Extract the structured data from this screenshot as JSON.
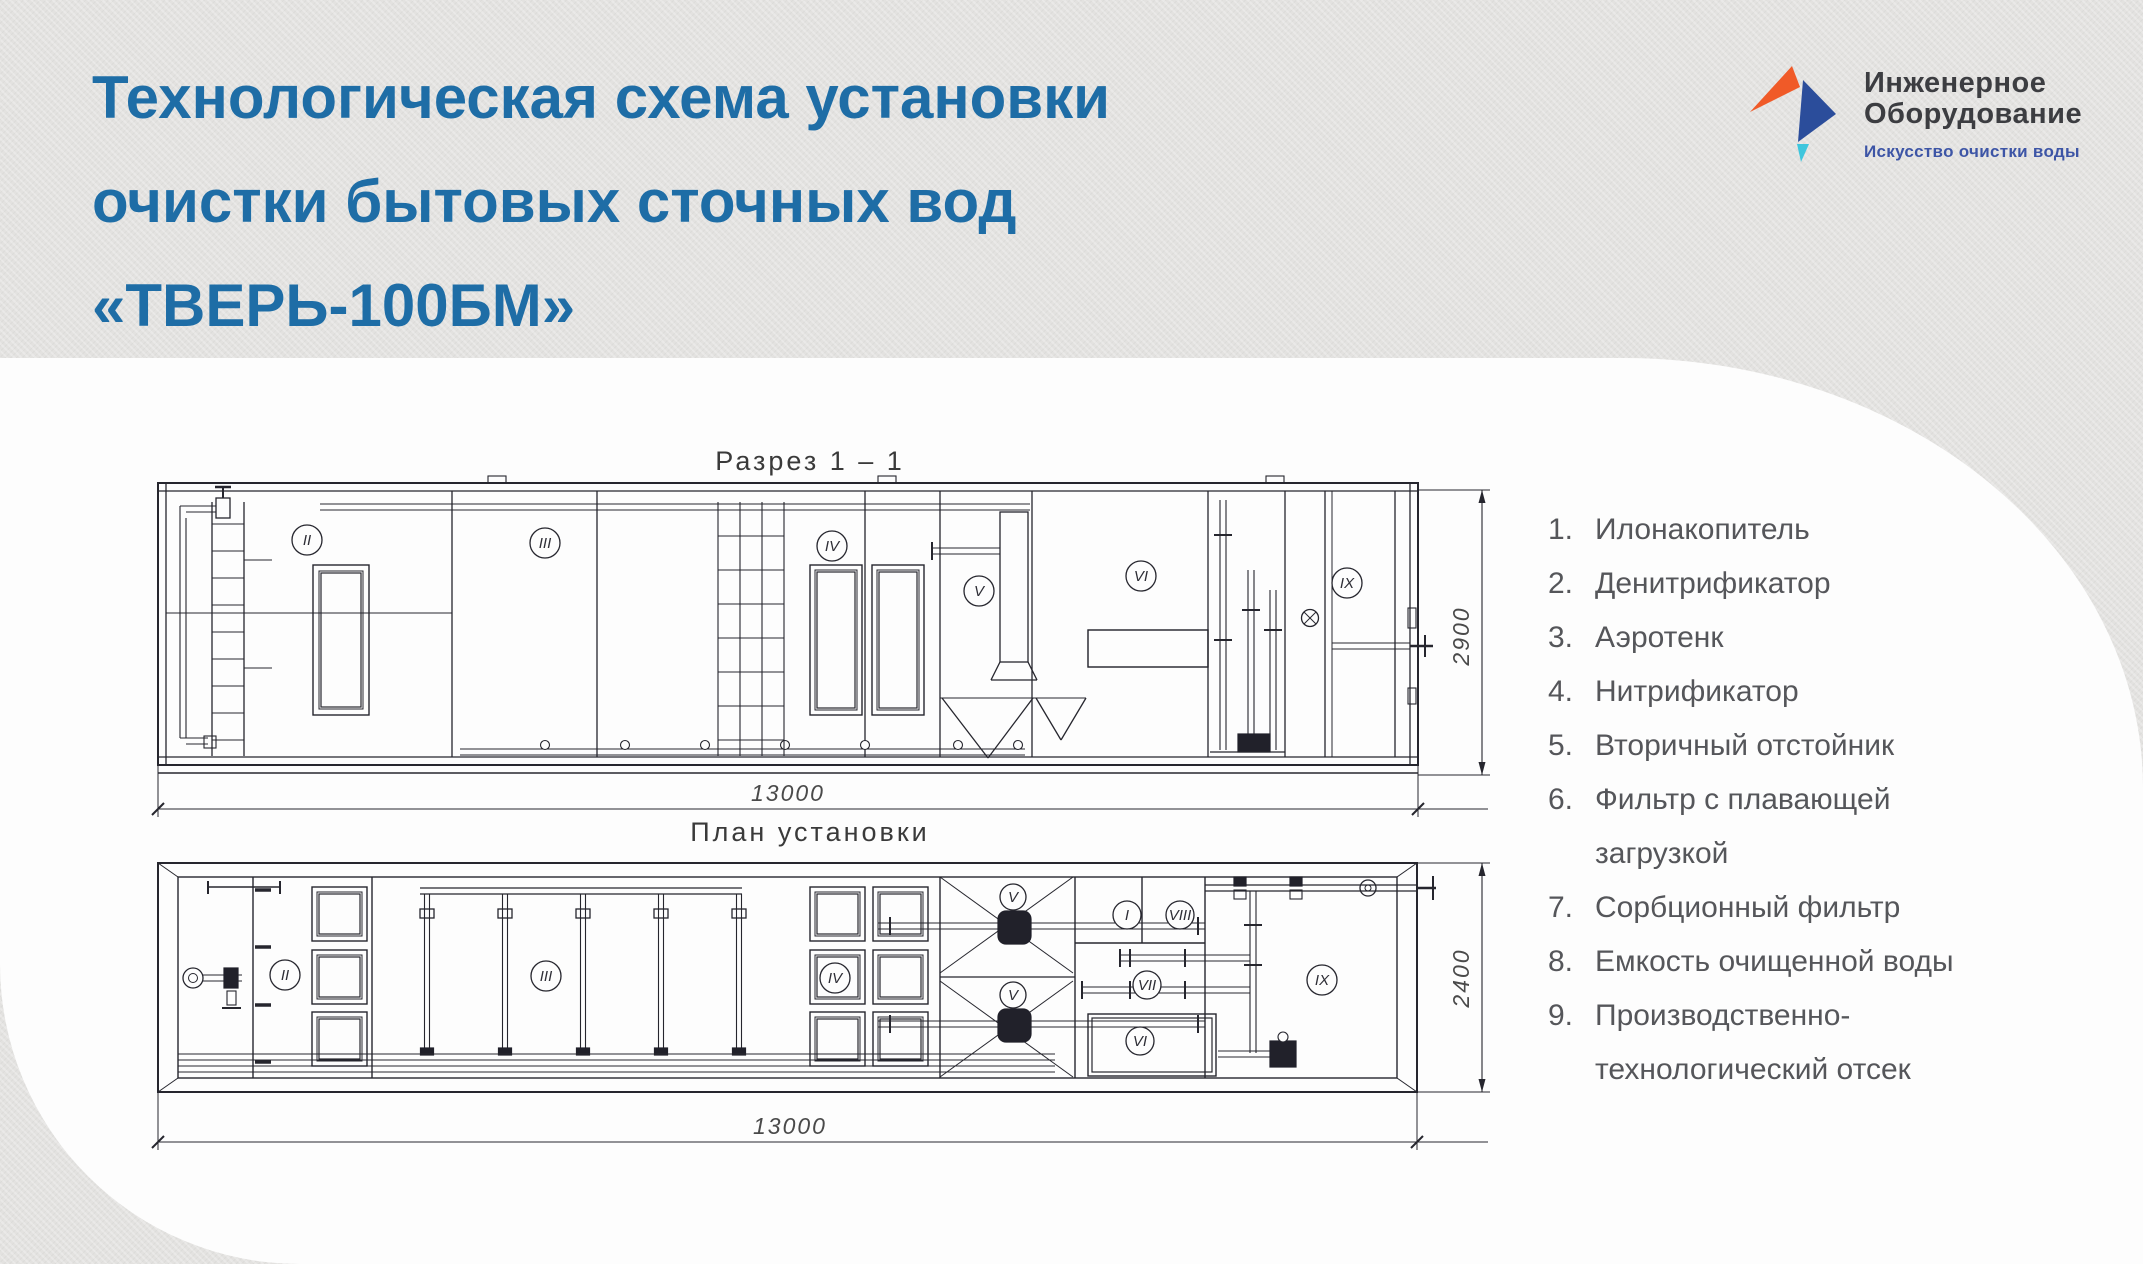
{
  "title": {
    "lines": [
      "Технологическая схема установки",
      "очистки бытовых сточных вод",
      "«ТВЕРЬ-100БМ»"
    ],
    "color": "#1e6da6"
  },
  "logo": {
    "name_line1": "Инженерное",
    "name_line2": "Оборудование",
    "tagline": "Искусство очистки воды",
    "mark_orange": "#f05a28",
    "mark_blue": "#2b4d9b",
    "mark_cyan": "#3ec6dd"
  },
  "legend": {
    "items": [
      "Илонакопитель",
      "Денитрификатор",
      "Аэротенк",
      "Нитрификатор",
      "Вторичный отстойник",
      "Фильтр с плавающей загрузкой",
      "Сорбционный фильтр",
      "Емкость очищенной воды",
      "Производственно-технологический отсек"
    ]
  },
  "drawings": {
    "section": {
      "title": "Разрез  1 – 1",
      "length_dim": "13000",
      "height_dim": "2900",
      "labels": [
        "II",
        "III",
        "IV",
        "V",
        "VI",
        "IX"
      ]
    },
    "plan": {
      "title": "План  установки",
      "length_dim": "13000",
      "width_dim": "2400",
      "labels": [
        "II",
        "III",
        "IV",
        "V",
        "V",
        "I",
        "VIII",
        "VII",
        "VI",
        "IX"
      ]
    }
  }
}
